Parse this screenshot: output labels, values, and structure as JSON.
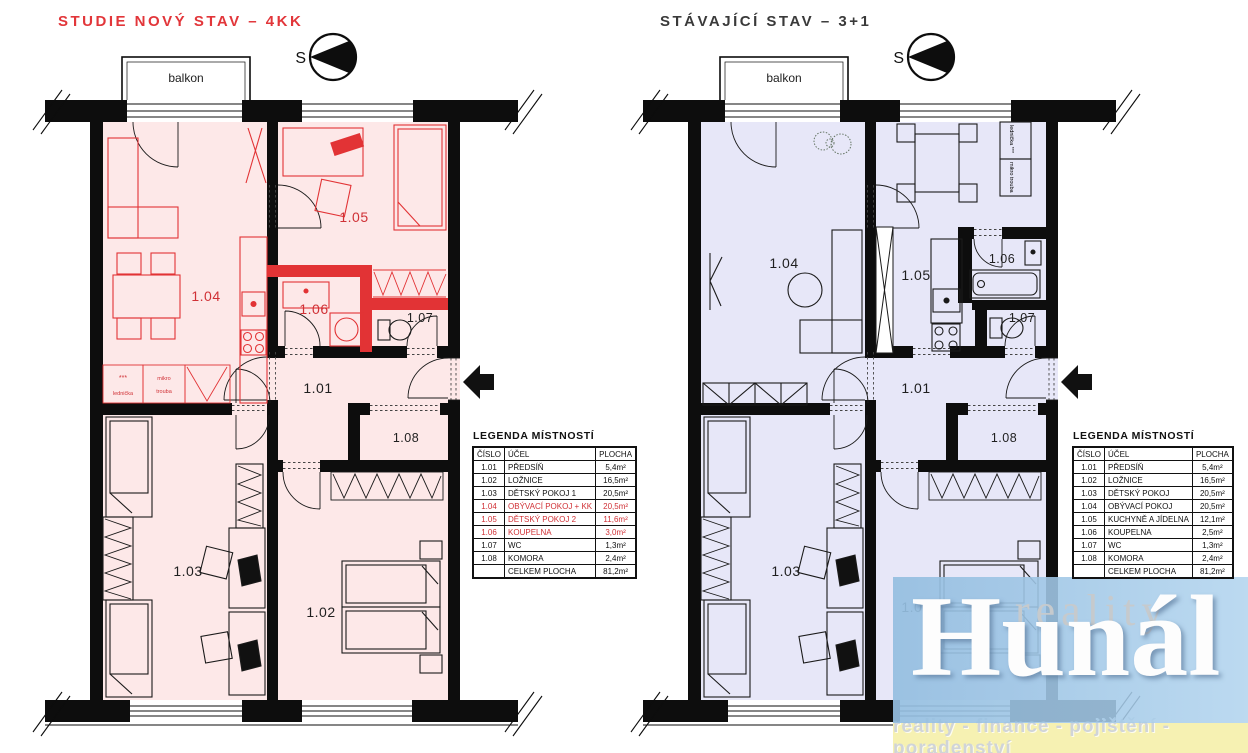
{
  "left_plan": {
    "title": "STUDIE NOVÝ STAV – 4KK",
    "balcony_label": "balkon",
    "compass_label": "S",
    "rooms": [
      "1.01",
      "1.02",
      "1.03",
      "1.04",
      "1.05",
      "1.06",
      "1.07",
      "1.08"
    ],
    "appliances": {
      "stars": "***",
      "fridge": "lednička",
      "micro": "mikro",
      "oven": "trouba"
    },
    "legend": {
      "title": "LEGENDA MÍSTNOSTÍ",
      "headers": [
        "ČÍSLO",
        "ÚČEL",
        "PLOCHA"
      ],
      "rows": [
        {
          "cislo": "1.01",
          "ucel": "PŘEDSÍŇ",
          "plocha": "5,4m²"
        },
        {
          "cislo": "1.02",
          "ucel": "LOŽNICE",
          "plocha": "16,5m²"
        },
        {
          "cislo": "1.03",
          "ucel": "DĚTSKÝ POKOJ 1",
          "plocha": "20,5m²"
        },
        {
          "cislo": "1.04",
          "ucel": "OBÝVACÍ POKOJ + KK",
          "plocha": "20,5m²"
        },
        {
          "cislo": "1.05",
          "ucel": "DĚTSKÝ POKOJ 2",
          "plocha": "11,6m²"
        },
        {
          "cislo": "1.06",
          "ucel": "KOUPELNA",
          "plocha": "3,0m²"
        },
        {
          "cislo": "1.07",
          "ucel": "WC",
          "plocha": "1,3m²"
        },
        {
          "cislo": "1.08",
          "ucel": "KOMORA",
          "plocha": "2,4m²"
        },
        {
          "cislo": "",
          "ucel": "CELKEM PLOCHA",
          "plocha": "81,2m²"
        }
      ]
    }
  },
  "right_plan": {
    "title": "STÁVAJÍCÍ STAV – 3+1",
    "balcony_label": "balkon",
    "compass_label": "S",
    "rooms": [
      "1.01",
      "1.02",
      "1.03",
      "1.04",
      "1.05",
      "1.06",
      "1.07",
      "1.08"
    ],
    "appliances": {
      "fridge_line": "lednička ***",
      "oven_line": "mikro trouba"
    },
    "legend": {
      "title": "LEGENDA MÍSTNOSTÍ",
      "headers": [
        "ČÍSLO",
        "ÚČEL",
        "PLOCHA"
      ],
      "rows": [
        {
          "cislo": "1.01",
          "ucel": "PŘEDSÍŇ",
          "plocha": "5,4m²"
        },
        {
          "cislo": "1.02",
          "ucel": "LOŽNICE",
          "plocha": "16,5m²"
        },
        {
          "cislo": "1.03",
          "ucel": "DĚTSKÝ POKOJ",
          "plocha": "20,5m²"
        },
        {
          "cislo": "1.04",
          "ucel": "OBÝVACÍ POKOJ",
          "plocha": "20,5m²"
        },
        {
          "cislo": "1.05",
          "ucel": "KUCHYNĚ A JÍDELNA",
          "plocha": "12,1m²"
        },
        {
          "cislo": "1.06",
          "ucel": "KOUPELNA",
          "plocha": "2,5m²"
        },
        {
          "cislo": "1.07",
          "ucel": "WC",
          "plocha": "1,3m²"
        },
        {
          "cislo": "1.08",
          "ucel": "KOMORA",
          "plocha": "2,4m²"
        },
        {
          "cislo": "",
          "ucel": "CELKEM PLOCHA",
          "plocha": "81,2m²"
        }
      ]
    }
  },
  "watermark": {
    "brand_top": "reality",
    "brand_main": "Hunál",
    "tagline": "reality - finance - pojištění - poradenství"
  },
  "colors": {
    "left_accent": "#e23335",
    "left_fill": "#fde8e8",
    "right_fill": "#e7e7f8",
    "wall": "#0d0d0d",
    "watermark_blue": "#a9cde9",
    "watermark_yellow": "#f6f1b2"
  }
}
